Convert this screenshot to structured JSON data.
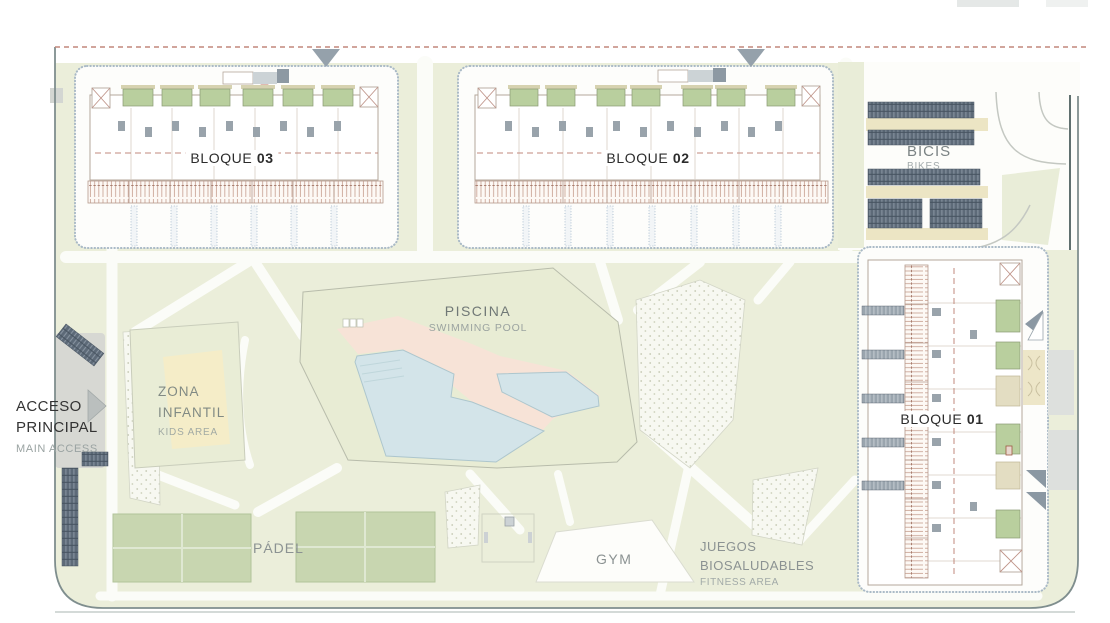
{
  "site": {
    "labels": {
      "bloque_03": {
        "name": "BLOQUE",
        "number": "03"
      },
      "bloque_02": {
        "name": "BLOQUE",
        "number": "02"
      },
      "bloque_01": {
        "name": "BLOQUE",
        "number": "01"
      },
      "piscina": {
        "title": "PISCINA",
        "subtitle": "SWIMMING POOL"
      },
      "zona_infantil": {
        "line1": "ZONA",
        "line2": "INFANTIL",
        "subtitle": "KIDS AREA"
      },
      "acceso": {
        "line1": "ACCESO",
        "line2": "PRINCIPAL",
        "subtitle": "MAIN ACCESS"
      },
      "padel": {
        "title": "PÁDEL"
      },
      "gym": {
        "title": "GYM"
      },
      "juegos": {
        "line1": "JUEGOS",
        "line2": "BIOSALUDABLES",
        "subtitle": "FITNESS AREA"
      },
      "bicis": {
        "title": "BICIS",
        "subtitle": "BIKES"
      }
    },
    "colors": {
      "lawn": "#ebeeda",
      "pool_lawn": "#e8ecd4",
      "padel_court": "#c8d6b0",
      "patio_green": "#b9cf9e",
      "patio_beige": "#e3ddc2",
      "pool_water": "#d3e4e9",
      "pool_deck": "#f7e3d7",
      "kids_yellow": "#f5edc8",
      "bike_rack": "#5d6a78",
      "access_road": "#d7d8d3",
      "boundary_line": "#7f8e8e",
      "dashed_limit": "#c2877b",
      "building_outline": "#b4a79b",
      "label_dark": "#303030",
      "label_gray": "#858e8b"
    }
  }
}
